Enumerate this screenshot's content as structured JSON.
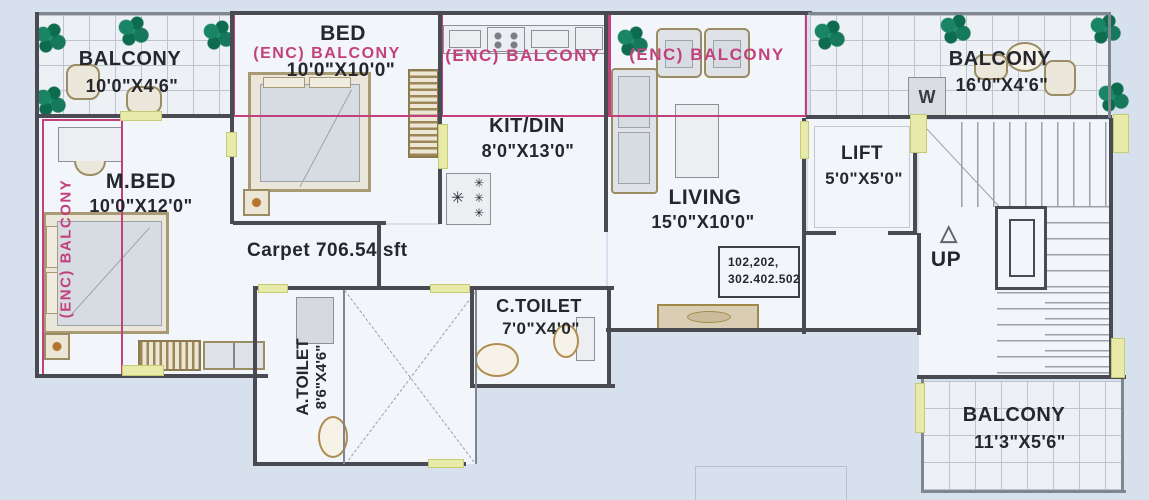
{
  "colors": {
    "background": "#d7e1ee",
    "wall": "#4a4a52",
    "enc_balcony_pink": "#c2417d",
    "door_yellow": "#e7eaa9",
    "plant_green": "#147a58"
  },
  "rooms": {
    "balcony_top_left": {
      "name": "BALCONY",
      "dims": "10'0\"X4'6\""
    },
    "bed": {
      "name": "BED",
      "dims": "10'0\"X10'0\""
    },
    "m_bed": {
      "name": "M.BED",
      "dims": "10'0\"X12'0\""
    },
    "kit_din": {
      "name": "KIT/DIN",
      "dims": "8'0\"X13'0\""
    },
    "living": {
      "name": "LIVING",
      "dims": "15'0\"X10'0\""
    },
    "lift": {
      "name": "LIFT",
      "dims": "5'0\"X5'0\""
    },
    "balcony_top_right": {
      "name": "BALCONY",
      "dims": "16'0\"X4'6\""
    },
    "balcony_bottom_right": {
      "name": "BALCONY",
      "dims": "11'3\"X5'6\""
    },
    "a_toilet": {
      "name": "A.TOILET",
      "dims": "8'6\"X4'6\""
    },
    "c_toilet": {
      "name": "C.TOILET",
      "dims": "7'0\"X4'0\""
    }
  },
  "enc_balcony_label": "(ENC) BALCONY",
  "annotations": {
    "carpet_area": "Carpet 706.54 sft",
    "unit_numbers_line1": "102,202,",
    "unit_numbers_line2": "302.402.502",
    "stairs_direction": "UP",
    "washing_machine": "W"
  },
  "icons": {
    "up_triangle": "△",
    "freezer_mark": "✳"
  }
}
